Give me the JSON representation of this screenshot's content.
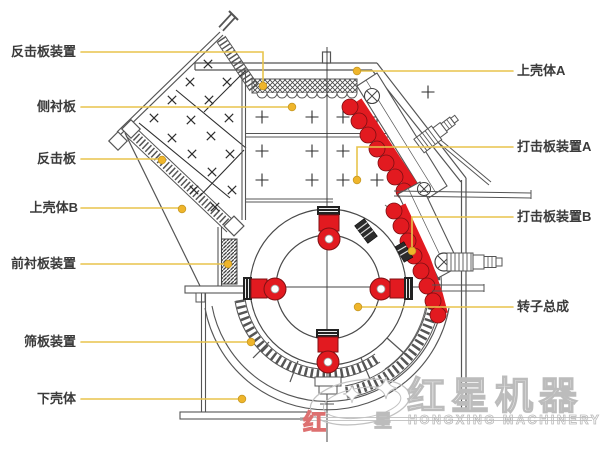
{
  "labels": {
    "left": [
      {
        "text": "反击板装置"
      },
      {
        "text": "侧衬板"
      },
      {
        "text": "反击板"
      },
      {
        "text": "上壳体B"
      },
      {
        "text": "前衬板装置"
      },
      {
        "text": "筛板装置"
      },
      {
        "text": "下壳体"
      }
    ],
    "right": [
      {
        "text": "上壳体A"
      },
      {
        "text": "打击板装置A"
      },
      {
        "text": "打击板装置B"
      },
      {
        "text": "转子总成"
      }
    ]
  },
  "watermark": {
    "brand_cn": "红星机器",
    "brand_en": "HONGXING MACHINERY",
    "stray_char_red": "红",
    "stray_char_gray": "星"
  },
  "colors": {
    "callout_line": "#e8c44c",
    "callout_dot": "#efb52b",
    "part_red": "#e21a20",
    "drawing_line": "#555555",
    "watermark_gray": "#bcbcbc",
    "watermark_red": "#dd7070",
    "label_text": "#3a3a3a"
  }
}
